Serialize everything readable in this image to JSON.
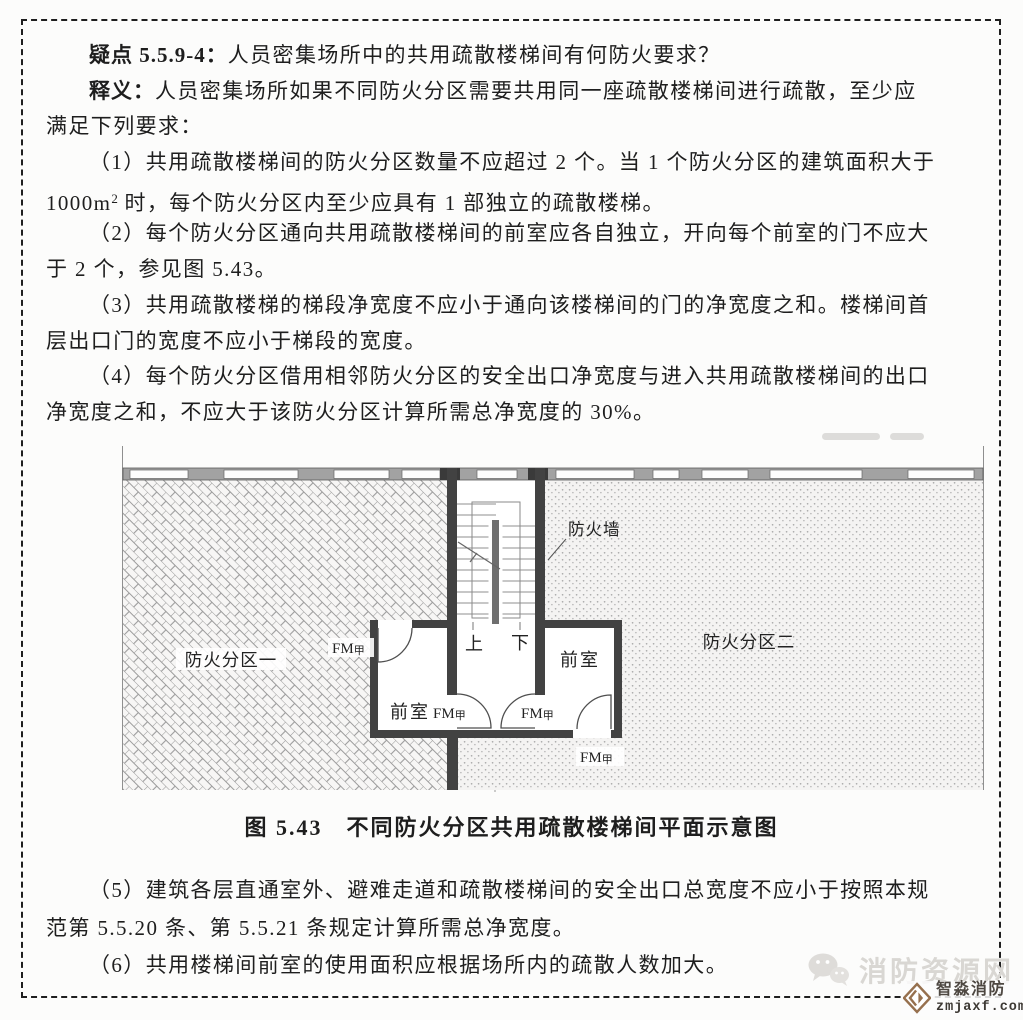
{
  "document": {
    "q_label": "疑点 5.5.9-4：",
    "q_text": "人员密集场所中的共用疏散楼梯间有何防火要求？",
    "a_label": "释义：",
    "a_line1": "人员密集场所如果不同防火分区需要共用同一座疏散楼梯间进行疏散，至少应",
    "a_line2": "满足下列要求：",
    "p1_line1": "（1）共用疏散楼梯间的防火分区数量不应超过 2 个。当 1 个防火分区的建筑面积大于",
    "p1_line2_pre": "1000m",
    "p1_line2_sup": "2",
    "p1_line2_post": " 时，每个防火分区内至少应具有 1 部独立的疏散楼梯。",
    "p2_line1": "（2）每个防火分区通向共用疏散楼梯间的前室应各自独立，开向每个前室的门不应大",
    "p2_line2": "于 2 个，参见图 5.43。",
    "p3_line1": "（3）共用疏散楼梯的梯段净宽度不应小于通向该楼梯间的门的净宽度之和。楼梯间首",
    "p3_line2": "层出口门的宽度不应小于梯段的宽度。",
    "p4_line1": "（4）每个防火分区借用相邻防火分区的安全出口净宽度与进入共用疏散楼梯间的出口",
    "p4_line2": "净宽度之和，不应大于该防火分区计算所需总净宽度的 30%。",
    "figure_caption": "图 5.43　不同防火分区共用疏散楼梯间平面示意图",
    "p5_line1": "（5）建筑各层直通室外、避难走道和疏散楼梯间的安全出口总宽度不应小于按照本规",
    "p5_line2": "范第 5.5.20 条、第 5.5.21 条规定计算所需总净宽度。",
    "p6": "（6）共用楼梯间前室的使用面积应根据场所内的疏散人数加大。"
  },
  "diagram": {
    "zone1": "防火分区一",
    "zone2": "防火分区二",
    "firewall": "防火墙",
    "anteroom": "前室",
    "up": "上",
    "down": "下",
    "fm_prefix": "FM",
    "fm_suffix": "甲"
  },
  "watermark": {
    "site": "消防资源网",
    "brand": "智淼消防",
    "url": "zmjaxf.com"
  },
  "colors": {
    "wall": "#424242",
    "hatch_line": "#9c9c9c",
    "wall_band": "#a2a2a2",
    "text": "#1e1e1e",
    "watermark_gray": "#d9d7d3",
    "brand_brown": "#96704e"
  }
}
